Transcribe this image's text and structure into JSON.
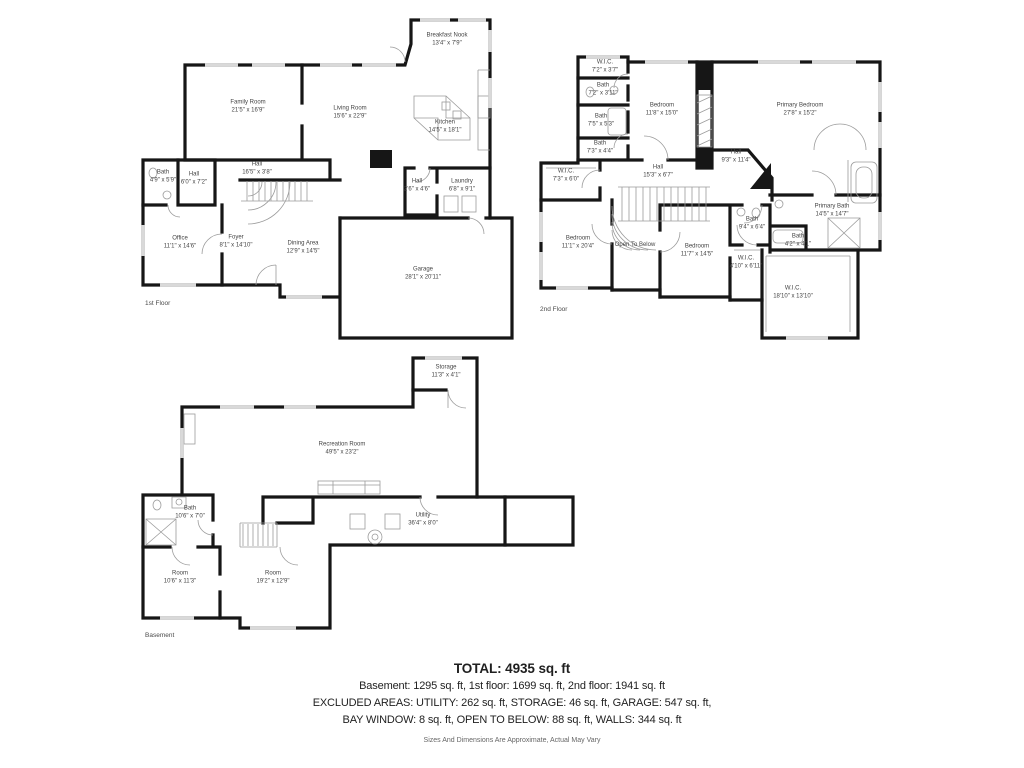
{
  "colors": {
    "wall": "#161616",
    "thin_line": "#9b9b9b",
    "window": "#d9d9d9",
    "label_text": "#444444",
    "summary_text": "#1f1f1f",
    "disclaimer_text": "#666666"
  },
  "floors": [
    {
      "name": "1st Floor",
      "label_x": 145,
      "label_y": 300,
      "rooms": [
        {
          "name": "Breakfast Nook",
          "dims": "13'4\" x 7'9\"",
          "x": 447,
          "y": 40
        },
        {
          "name": "Family Room",
          "dims": "21'5\" x 16'9\"",
          "x": 248,
          "y": 107
        },
        {
          "name": "Living Room",
          "dims": "15'6\" x 22'9\"",
          "x": 350,
          "y": 113
        },
        {
          "name": "Kitchen",
          "dims": "14'5\" x 18'1\"",
          "x": 445,
          "y": 127
        },
        {
          "name": "Hall",
          "dims": "16'5\" x 3'8\"",
          "x": 257,
          "y": 169
        },
        {
          "name": "Bath",
          "dims": "4'9\" x 5'9\"",
          "x": 163,
          "y": 177
        },
        {
          "name": "Hall",
          "dims": "6'0\" x 7'2\"",
          "x": 194,
          "y": 179
        },
        {
          "name": "Hall",
          "dims": "2'6\" x 4'6\"",
          "x": 417,
          "y": 186
        },
        {
          "name": "Laundry",
          "dims": "6'8\" x 9'1\"",
          "x": 462,
          "y": 186
        },
        {
          "name": "Office",
          "dims": "11'1\" x 14'6\"",
          "x": 180,
          "y": 243
        },
        {
          "name": "Foyer",
          "dims": "8'1\" x 14'10\"",
          "x": 236,
          "y": 242
        },
        {
          "name": "Dining Area",
          "dims": "12'9\" x 14'5\"",
          "x": 303,
          "y": 248
        },
        {
          "name": "Garage",
          "dims": "28'1\" x 20'11\"",
          "x": 423,
          "y": 274
        }
      ]
    },
    {
      "name": "2nd Floor",
      "label_x": 540,
      "label_y": 306,
      "rooms": [
        {
          "name": "W.I.C.",
          "dims": "7'2\" x 3'7\"",
          "x": 605,
          "y": 67
        },
        {
          "name": "Bath",
          "dims": "7'2\" x 3'11\"",
          "x": 603,
          "y": 90
        },
        {
          "name": "Bath",
          "dims": "7'5\" x 5'3\"",
          "x": 601,
          "y": 121
        },
        {
          "name": "Bath",
          "dims": "7'3\" x 4'4\"",
          "x": 600,
          "y": 148
        },
        {
          "name": "Bedroom",
          "dims": "11'8\" x 15'0\"",
          "x": 662,
          "y": 110
        },
        {
          "name": "Primary Bedroom",
          "dims": "27'8\" x 15'2\"",
          "x": 800,
          "y": 110
        },
        {
          "name": "Hall",
          "dims": "15'3\" x 6'7\"",
          "x": 658,
          "y": 172
        },
        {
          "name": "Hall",
          "dims": "9'3\" x 11'4\"",
          "x": 736,
          "y": 157
        },
        {
          "name": "W.I.C.",
          "dims": "7'3\" x 6'0\"",
          "x": 566,
          "y": 176
        },
        {
          "name": "Bedroom",
          "dims": "11'1\" x 20'4\"",
          "x": 578,
          "y": 243
        },
        {
          "name": "Open To Below",
          "dims": "",
          "x": 635,
          "y": 245
        },
        {
          "name": "Bedroom",
          "dims": "11'7\" x 14'5\"",
          "x": 697,
          "y": 251
        },
        {
          "name": "Bath",
          "dims": "9'4\" x 6'4\"",
          "x": 752,
          "y": 224
        },
        {
          "name": "Bath",
          "dims": "4'2\" x 4'1\"",
          "x": 798,
          "y": 241
        },
        {
          "name": "W.I.C.",
          "dims": "4'10\" x 6'11\"",
          "x": 746,
          "y": 263
        },
        {
          "name": "Primary Bath",
          "dims": "14'5\" x 14'7\"",
          "x": 832,
          "y": 211
        },
        {
          "name": "W.I.C.",
          "dims": "18'10\" x 13'10\"",
          "x": 793,
          "y": 293
        }
      ]
    },
    {
      "name": "Basement",
      "label_x": 145,
      "label_y": 632,
      "rooms": [
        {
          "name": "Storage",
          "dims": "11'3\" x 4'1\"",
          "x": 446,
          "y": 372
        },
        {
          "name": "Recreation Room",
          "dims": "49'5\" x 23'2\"",
          "x": 342,
          "y": 449
        },
        {
          "name": "Bath",
          "dims": "10'6\" x 7'0\"",
          "x": 190,
          "y": 513
        },
        {
          "name": "Utility",
          "dims": "36'4\" x 8'0\"",
          "x": 423,
          "y": 520
        },
        {
          "name": "Room",
          "dims": "10'6\" x 11'3\"",
          "x": 180,
          "y": 578
        },
        {
          "name": "Room",
          "dims": "19'2\" x 12'9\"",
          "x": 273,
          "y": 578
        }
      ]
    }
  ],
  "summary": {
    "total": "TOTAL: 4935 sq. ft",
    "line1": "Basement: 1295 sq. ft, 1st floor: 1699 sq. ft, 2nd floor: 1941 sq. ft",
    "line2": "EXCLUDED AREAS: UTILITY: 262 sq. ft, STORAGE: 46 sq. ft, GARAGE: 547 sq. ft,",
    "line3": "BAY WINDOW: 8 sq. ft, OPEN TO BELOW: 88 sq. ft, WALLS: 344 sq. ft",
    "disclaimer": "Sizes And Dimensions Are Approximate, Actual May Vary"
  }
}
